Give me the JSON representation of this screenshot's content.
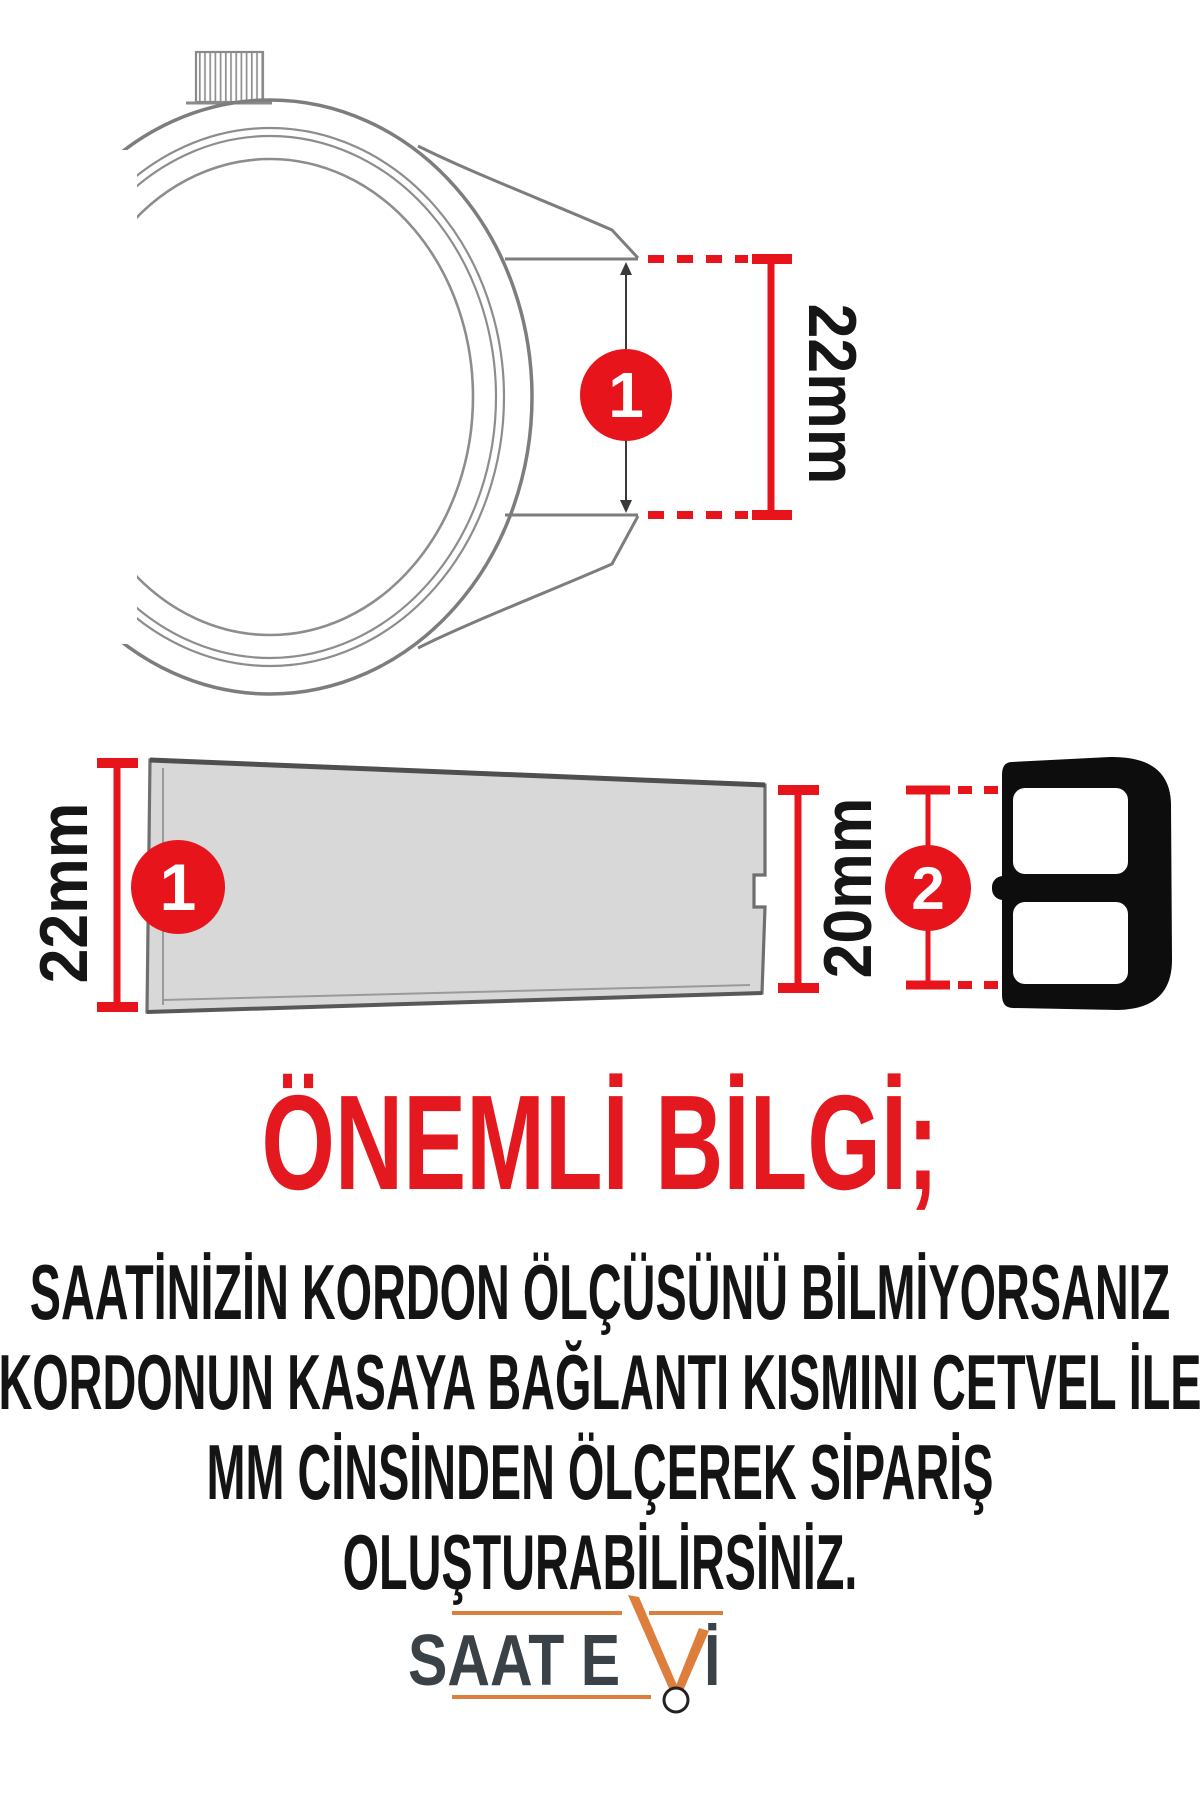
{
  "measurements": {
    "step1": "1",
    "step2": "2",
    "lug_width_label": "22mm",
    "strap_width_label": "22mm",
    "buckle_width_label": "20mm"
  },
  "notice": {
    "heading": "ÖNEMLİ BİLGİ;",
    "lines": [
      "SAATİNİZİN KORDON ÖLÇÜSÜNÜ BİLMİYORSANIZ",
      "KORDONUN KASAYA BAĞLANTI KISMINI CETVEL İLE",
      "MM CİNSİNDEN ÖLÇEREK SİPARİŞ",
      "OLUŞTURABİLİRSİNİZ."
    ]
  },
  "brand": {
    "name_left": "SAAT E",
    "name_right": "İ"
  },
  "colors": {
    "accent_red": "#e8141c",
    "heading_red": "#e4191f",
    "text_black": "#141414",
    "strap_gray": "#d8d8d8",
    "outline_gray": "#7d7d7d",
    "buckle_black": "#0d0d0d",
    "logo_orange": "#dd7e3c",
    "logo_charcoal": "#3b4247"
  }
}
